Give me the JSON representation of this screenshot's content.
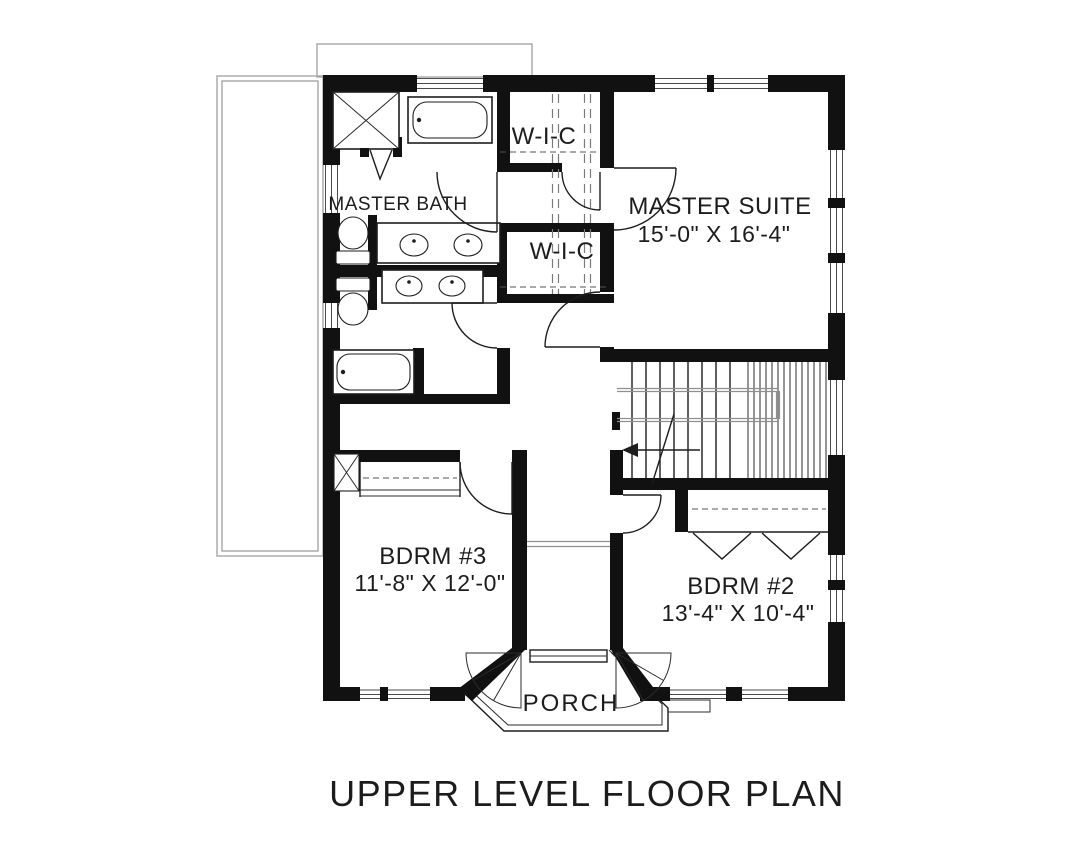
{
  "plan": {
    "title": "UPPER LEVEL FLOOR PLAN",
    "rooms": {
      "master_suite": {
        "name": "MASTER SUITE",
        "dims": "15'-0\" X 16'-4\""
      },
      "master_bath": {
        "name": "MASTER BATH"
      },
      "wic_upper": {
        "name": "W-I-C"
      },
      "wic_lower": {
        "name": "W-I-C"
      },
      "bdrm3": {
        "name": "BDRM #3",
        "dims": "11'-8\" X 12'-0\""
      },
      "bdrm2": {
        "name": "BDRM #2",
        "dims": "13'-4\" X 10'-4\""
      },
      "porch": {
        "name": "PORCH"
      }
    },
    "colors": {
      "background": "#ffffff",
      "wall_ink": "#111111",
      "text_ink": "#1c1c1c",
      "thin_line": "#8f8f8f"
    }
  }
}
